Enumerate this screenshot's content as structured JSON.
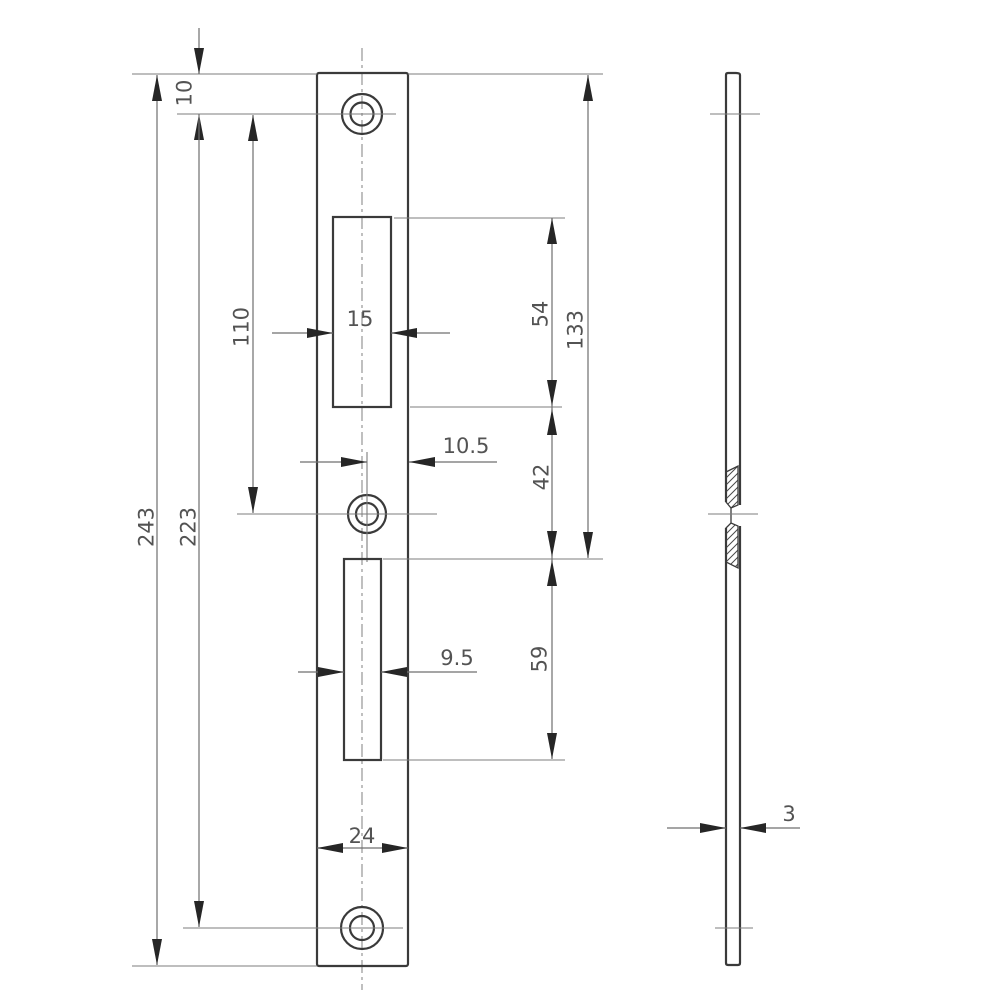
{
  "drawing": {
    "kind": "technical-drawing",
    "part": "strike-plate",
    "views": [
      "front",
      "side-section"
    ]
  },
  "dimensions": {
    "top_edge_to_top_hole": "10",
    "top_hole_to_center_hole": "110",
    "plate_length": "243",
    "screw_hole_spacing": "223",
    "top_cutout_width": "15",
    "top_cutout_height": "54",
    "top_edge_to_bottom_cutout": "133",
    "center_hole_offset": "10.5",
    "between_cutouts": "42",
    "bottom_cutout_width": "9.5",
    "bottom_cutout_height": "59",
    "plate_width": "24",
    "plate_thickness": "3"
  },
  "colors": {
    "object_line": "#3a3a3a",
    "dimension_line": "#6f6f6f",
    "extension_line": "#7d7d7d",
    "arrow": "#262626",
    "label_text": "#535353",
    "background": "#ffffff"
  }
}
